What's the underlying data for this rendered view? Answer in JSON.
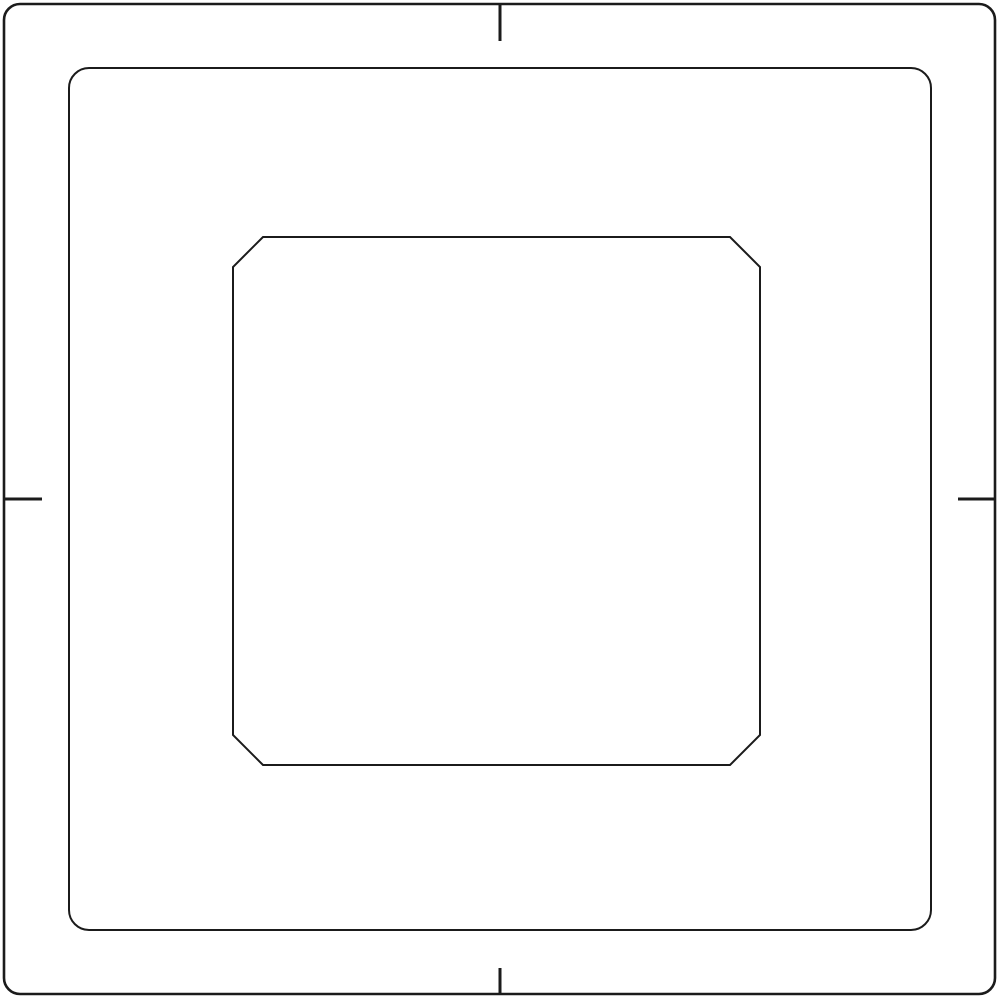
{
  "canvas": {
    "width": 1000,
    "height": 1000,
    "background_color": "#ffffff"
  },
  "stroke": {
    "color": "#1b1b1b"
  },
  "shapes": {
    "outer_frame": {
      "type": "rounded-rect",
      "x": 4,
      "y": 4,
      "width": 991,
      "height": 990,
      "corner_radius": 16,
      "stroke_width": 2.6
    },
    "middle_frame": {
      "type": "rounded-rect",
      "x": 69,
      "y": 68,
      "width": 862,
      "height": 862,
      "corner_radius": 20,
      "stroke_width": 2
    },
    "inner_window": {
      "type": "chamfered-rect",
      "x": 233,
      "y": 237,
      "width": 527,
      "height": 528,
      "chamfer": 30,
      "stroke_width": 2
    }
  },
  "tick_marks": [
    {
      "name": "tick-top",
      "x1": 500,
      "y1": 4,
      "x2": 500,
      "y2": 41,
      "stroke_width": 3
    },
    {
      "name": "tick-bottom",
      "x1": 500,
      "y1": 968,
      "x2": 500,
      "y2": 994,
      "stroke_width": 3
    },
    {
      "name": "tick-left",
      "x1": 4,
      "y1": 499,
      "x2": 42,
      "y2": 499,
      "stroke_width": 3
    },
    {
      "name": "tick-right",
      "x1": 958,
      "y1": 499,
      "x2": 995,
      "y2": 499,
      "stroke_width": 3
    }
  ]
}
